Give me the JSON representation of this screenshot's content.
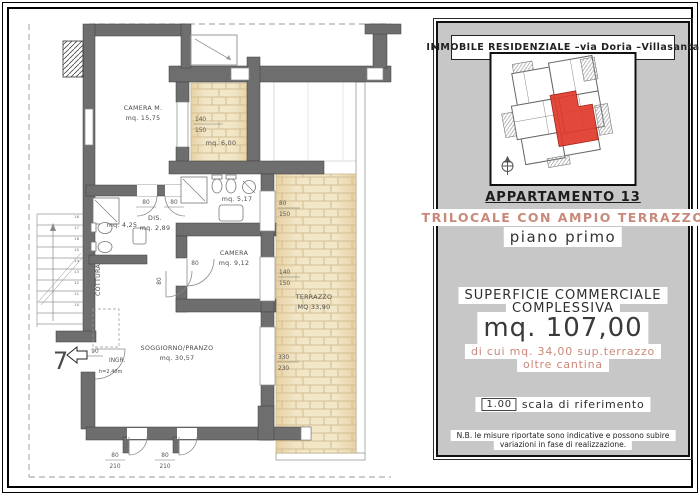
{
  "panel": {
    "header": "IMMOBILE  RESIDENZIALE   –via  Doria   –Villasanta",
    "apartment_name": "APPARTAMENTO 13",
    "apartment_type": "TRILOCALE  CON  AMPIO  TERRAZZO",
    "floor": "piano  primo",
    "surface_label_1": "SUPERFICIE  COMMERCIALE",
    "surface_label_2": "COMPLESSIVA",
    "surface_value": "mq.  107,00",
    "surface_detail_1": "di  cui  mq.  34,00  sup.terrazzo",
    "surface_detail_2": "oltre  cantina",
    "scale_value": "1.00",
    "scale_label": "scala  di  riferimento",
    "note_1": "N.B. le misure riportate sono indicative e possono subire",
    "note_2": "variazioni in fase di realizzazione.",
    "colors": {
      "panel_bg": "#c7c7c7",
      "accent": "#c9897a",
      "highlight_red": "#df3a2a"
    }
  },
  "plan": {
    "camera_m_name": "CAMERA M.",
    "camera_m_area": "mq. 15,75",
    "loggia_area": "mq. 6,00",
    "bath1_area": "mq. 5,17",
    "dis_name": "DIS.",
    "dis_area": "mq. 2,89",
    "bath2_area": "mq. 4,25",
    "cottura_label": "COTTURA",
    "camera_name": "CAMERA",
    "camera_area": "mq. 9,12",
    "terrazzo_name": "TERRAZZO",
    "terrazzo_area": "MQ 33,90",
    "soggiorno_name": "SOGGIORNO/PRANZO",
    "soggiorno_area": "mq. 30,57",
    "entrance_unit": "7",
    "entrance_width": "90",
    "entrance_label": "INGR.",
    "entrance_height": "h=2,40m",
    "dim_loggia_top": "140",
    "dim_loggia_bot": "150",
    "dim_door_a": "80",
    "dim_door_b": "80",
    "dim_door_camera": "80",
    "dim_door_soggiorno": "80",
    "dim_win1_top": "80",
    "dim_win1_bot": "150",
    "dim_win2_top": "140",
    "dim_win2_bot": "150",
    "dim_terracedoor_top": "330",
    "dim_terracedoor_bot": "230",
    "dim_sdoor_top": "80",
    "dim_sdoor_bot": "210",
    "stairs": [
      "18",
      "17",
      "16",
      "15",
      "14",
      "13",
      "12",
      "11",
      "10"
    ],
    "colors": {
      "wall": "#6e6e6e",
      "brick_fill": "#f1e6c6",
      "brick_line": "#c9b488"
    }
  }
}
